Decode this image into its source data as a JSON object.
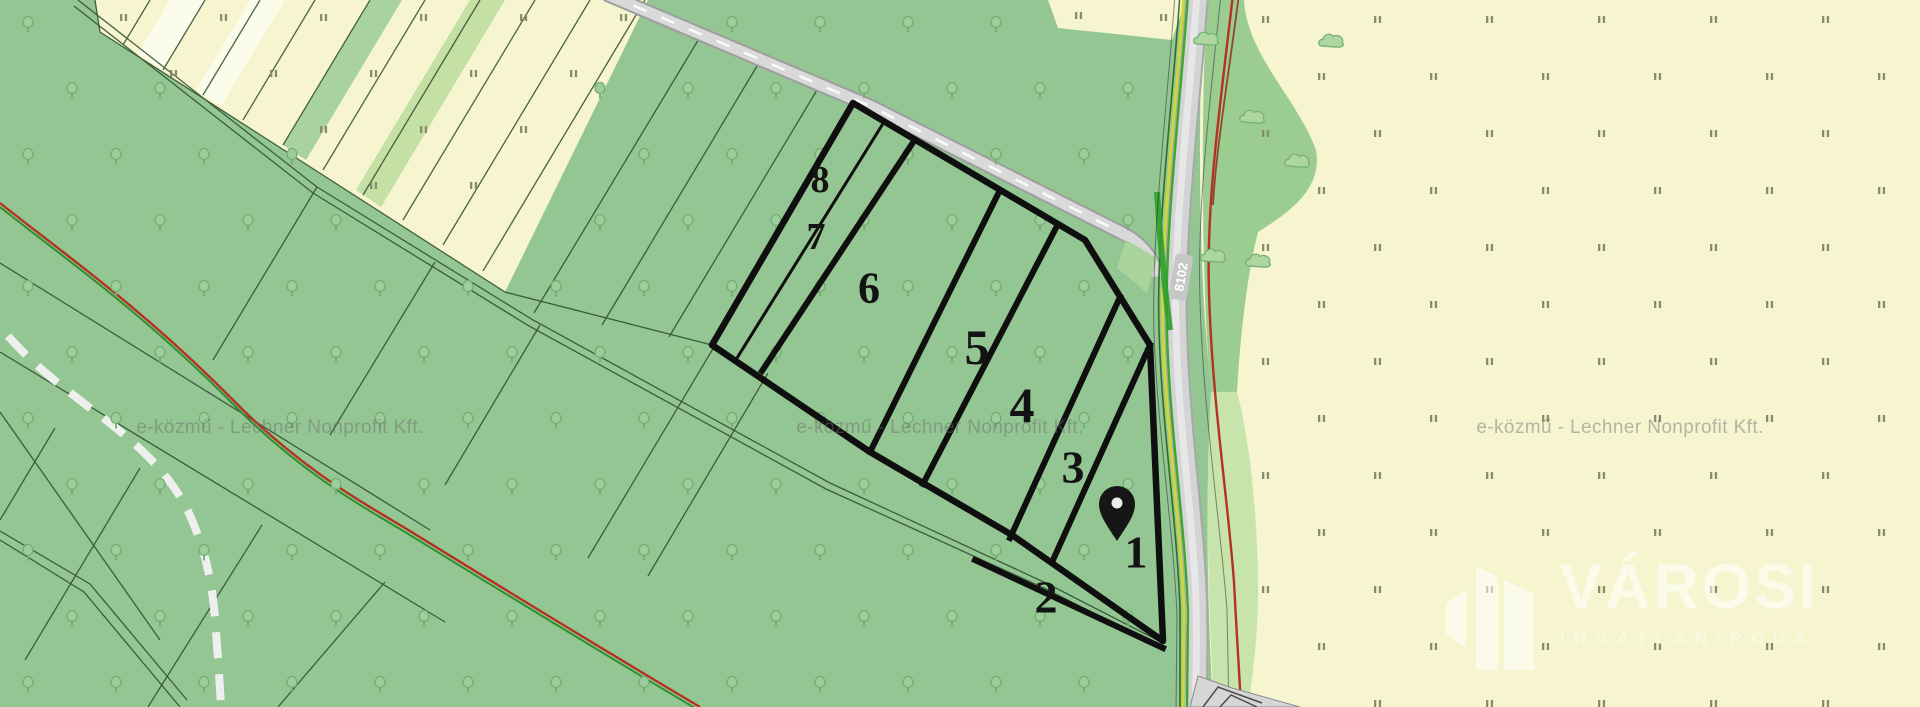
{
  "map": {
    "watermark": {
      "text": "e-közmű - Lechner Nonprofit Kft."
    },
    "road": {
      "route_number": "8102"
    },
    "parcels": [
      {
        "label": "1"
      },
      {
        "label": "2"
      },
      {
        "label": "3"
      },
      {
        "label": "4"
      },
      {
        "label": "5"
      },
      {
        "label": "6"
      },
      {
        "label": "7"
      },
      {
        "label": "8"
      }
    ],
    "marker": {
      "name": "location-pin"
    },
    "legend_colors": {
      "forest_green": "#93c693",
      "field_yellow": "#f6f5d0",
      "road_grey": "#d4d4d4",
      "boundary_black": "#0f0f0f",
      "utility_red": "#b53123",
      "utility_green": "#2f8f2f",
      "roadside_yellow_green": "#ccd83a",
      "light_green_strip": "#c7e4ac"
    },
    "logo": {
      "title": "VÁROSI",
      "subtitle": "INGATLANIRODA"
    }
  }
}
